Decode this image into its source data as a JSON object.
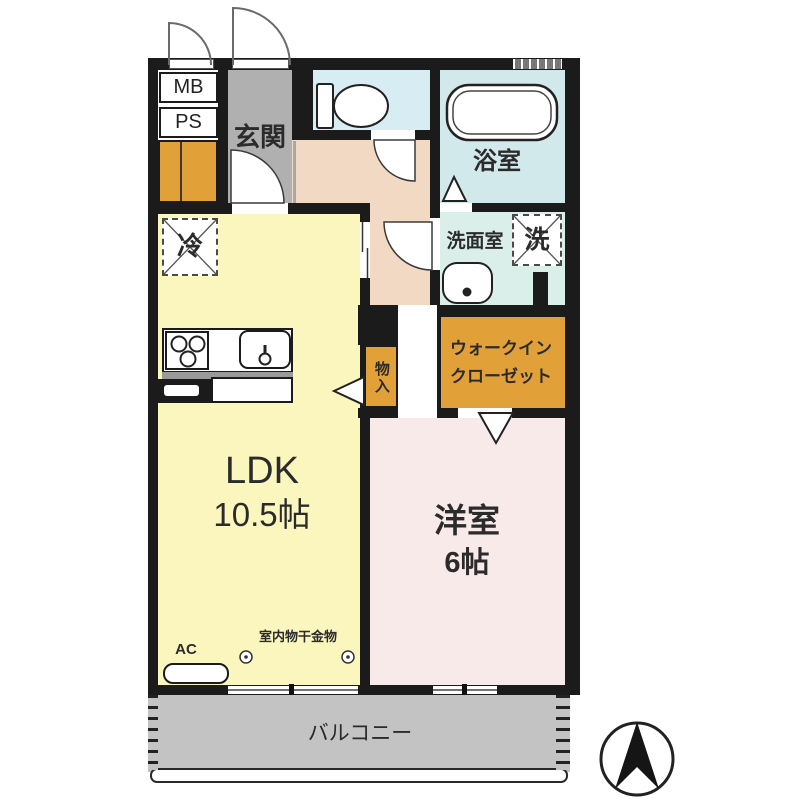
{
  "rooms": {
    "entrance": {
      "label": "玄関"
    },
    "bathroom": {
      "label": "浴室"
    },
    "washroom": {
      "label": "洗面室"
    },
    "walk_in_closet": {
      "line1": "ウォークイン",
      "line2": "クローゼット"
    },
    "storage": {
      "label": "物入"
    },
    "ldk": {
      "label": "LDK",
      "size": "10.5帖"
    },
    "western_room": {
      "label": "洋室",
      "size": "6帖"
    },
    "balcony": {
      "label": "バルコニー"
    }
  },
  "fixtures": {
    "meter_box": {
      "label": "MB"
    },
    "pipe_space": {
      "label": "PS"
    },
    "refrigerator": {
      "label": "冷"
    },
    "washing_machine": {
      "label": "洗"
    },
    "air_conditioner": {
      "label": "AC"
    },
    "indoor_laundry_hardware": {
      "label": "室内物干金物"
    }
  },
  "compass": {
    "icon": "north-arrow"
  },
  "colors": {
    "wall": "#1b1b1b",
    "ldk": "#faf6bd",
    "western_room": "#f8eae8",
    "hall": "#f2d9c3",
    "entrance": "#b0b0b0",
    "toilet": "#d8edf3",
    "bathroom": "#d2e9ec",
    "washroom": "#daefe9",
    "closet": "#e2a138",
    "balcony": "#c3c3c3"
  }
}
